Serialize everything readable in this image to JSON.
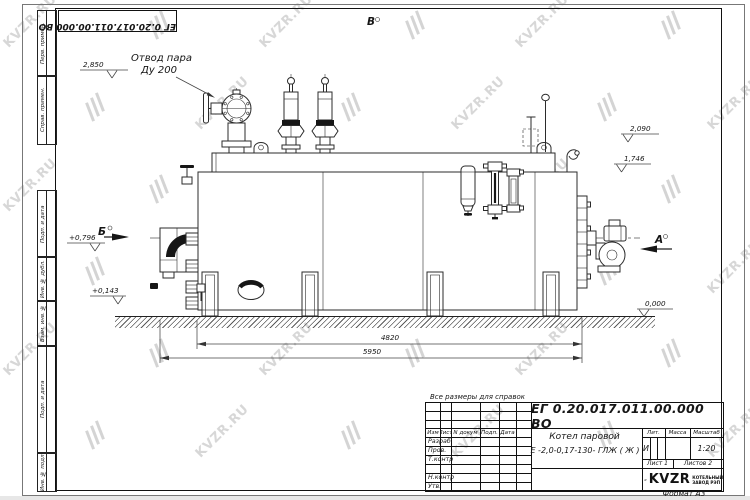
{
  "page": {
    "stamp_top": "ЕГ 0.20.017.011.00.000  ВО",
    "format_note": "Формат  А3"
  },
  "watermark": {
    "text": "KVZR.RU"
  },
  "side_labels": [
    "Перв. примен.",
    "Справ. примен.",
    "Подп. и дата",
    "Инв. № дубл.",
    "Взам. инв. №",
    "Подп. и дата",
    "Инв. № подл."
  ],
  "drawing": {
    "steam_note_line1": "Отвод пара",
    "steam_note_line2": "Ду 200",
    "view_top": "В",
    "view_left": "Б",
    "view_right": "А",
    "level_2850": "2,850",
    "level_2090": "2,090",
    "level_1746": "1,746",
    "level_0796": "+0,796",
    "level_0143": "+0,143",
    "level_0000": "0,000",
    "dim_4820": "4820",
    "dim_5950": "5950"
  },
  "titleblock": {
    "ref_note": "Все размеры для справок",
    "doc_number": "ЕГ 0.20.017.011.00.000  ВО",
    "product_line1": "Котел паровой",
    "product_line2": "Е -2,0-0,17-130- ГЛЖ ( Ж )",
    "col_izm": "Изм",
    "col_list": "Лист",
    "col_ndoc": "N докум",
    "col_podp": "Подп.",
    "col_data": "Дата",
    "row_razrab": "Разраб.",
    "row_prov": "Пров.",
    "row_tkontr": "Т.контр",
    "row_nkontr": "Н.контр",
    "row_utv": "Утв.",
    "lit_label": "Лит.",
    "mass_label": "Масса",
    "scale_label": "Масштаб",
    "lit_value": "И",
    "scale_value": "1:20",
    "sheet_text": "Лист 1",
    "sheets_text": "Листов 2",
    "logo_text": "KVZR",
    "logo_sub1": "КОТЕЛЬНЫЙ",
    "logo_sub2": "ЗАВОД РЭП"
  }
}
